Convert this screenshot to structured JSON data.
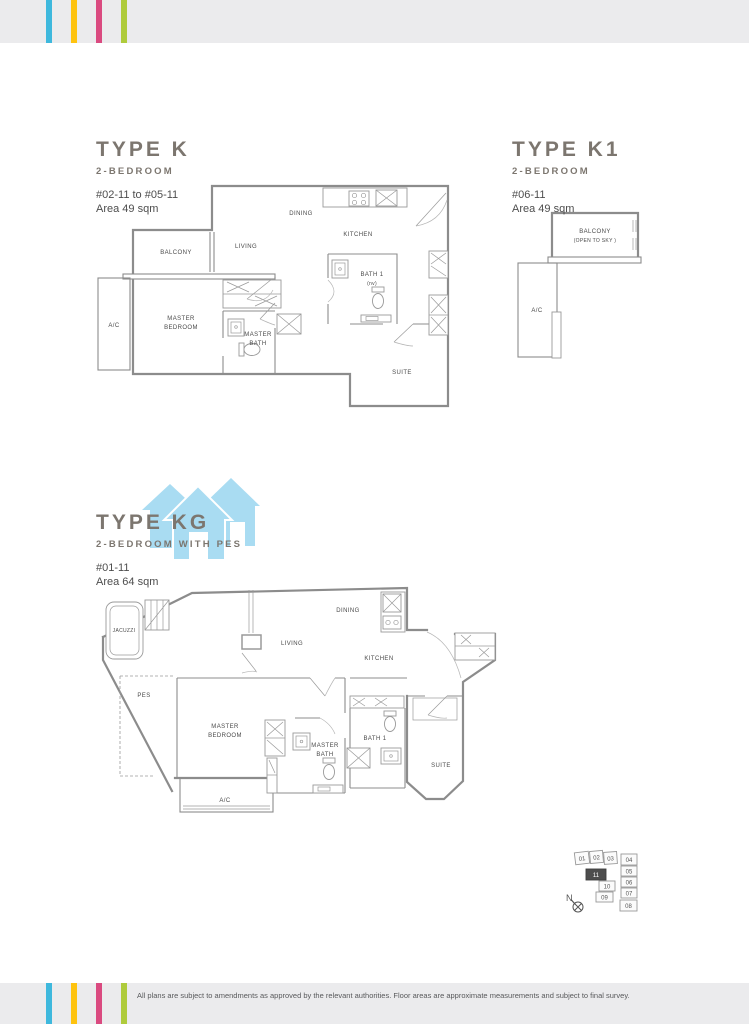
{
  "page": {
    "footer": "All plans are subject to amendments as approved by the relevant authorities. Floor areas are approximate measurements and subject to final survey."
  },
  "type_k": {
    "title": "TYPE K",
    "subtitle": "2-BEDROOM",
    "levels": "#02-11 to #05-11",
    "area": "Area 49 sqm",
    "rooms": {
      "balcony": "BALCONY",
      "living": "LIVING",
      "dining": "DINING",
      "kitchen": "KITCHEN",
      "bath1": "BATH 1",
      "bath1_note": "(nv)",
      "ac": "A/C",
      "master_bedroom_l1": "MASTER",
      "master_bedroom_l2": "BEDROOM",
      "master_bath_l1": "MASTER",
      "master_bath_l2": "BATH",
      "suite": "SUITE"
    }
  },
  "type_k1": {
    "title": "TYPE K1",
    "subtitle": "2-BEDROOM",
    "levels": "#06-11",
    "area": "Area 49 sqm",
    "rooms": {
      "balcony_l1": "BALCONY",
      "balcony_l2": "(OPEN TO SKY )",
      "ac": "A/C"
    }
  },
  "type_kg": {
    "title": "TYPE KG",
    "subtitle": "2-BEDROOM WITH PES",
    "levels": "#01-11",
    "area": "Area 64 sqm",
    "rooms": {
      "jacuzzi": "JACUZZI",
      "pes": "PES",
      "living": "LIVING",
      "dining": "DINING",
      "kitchen": "KITCHEN",
      "master_bedroom_l1": "MASTER",
      "master_bedroom_l2": "BEDROOM",
      "master_bath_l1": "MASTER",
      "master_bath_l2": "BATH",
      "bath1": "BATH 1",
      "suite": "SUITE",
      "ac": "A/C"
    }
  },
  "locator": {
    "north": "N",
    "highlighted_unit": "11",
    "units": {
      "u01": "01",
      "u02": "02",
      "u03": "03",
      "u04": "04",
      "u05": "05",
      "u06": "06",
      "u07": "07",
      "u08": "08",
      "u09": "09",
      "u10": "10",
      "u11": "11"
    }
  },
  "colors": {
    "stripe_cyan": "#3eb8dd",
    "stripe_yellow": "#fec310",
    "stripe_pink": "#da4a80",
    "stripe_green": "#afcb3c",
    "band_gray": "#ebebed",
    "logo_blue": "#a9dcf2",
    "heading_gray": "#7c766f"
  }
}
